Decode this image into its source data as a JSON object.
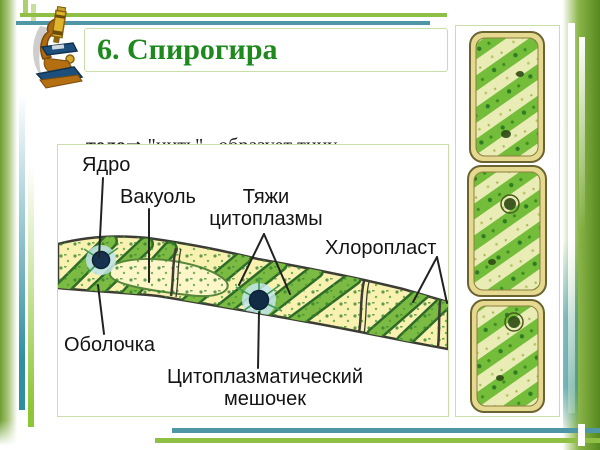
{
  "slide": {
    "title": "6. Спирогира",
    "body": {
      "line1_bold": "тело",
      "line1_rest": "⇒ \"нить\" , образует тину",
      "line2": "- хлоропласт  →  спиральный"
    }
  },
  "diagram": {
    "labels": {
      "yadro": "Ядро",
      "vakuol": "Вакуоль",
      "tyazhi_line1": "Тяжи",
      "tyazhi_line2": "цитоплазмы",
      "chloroplast": "Хлоропласт",
      "obolochka": "Оболочка",
      "sac_line1": "Цитоплазматический",
      "sac_line2": "мешочек"
    }
  },
  "icons": {
    "microscope": "microscope-icon"
  },
  "colors": {
    "title_green": "#1e8a1e",
    "box_border_green": "#c9dfa9",
    "rule_teal": "#4f96a6",
    "rule_green": "#8fbf45",
    "bar_green": "#6f9e33",
    "cell_fill_yellow": "#f8f1b0",
    "ribbon_green": "#7cbb43",
    "nucleus_navy": "#16324e"
  }
}
